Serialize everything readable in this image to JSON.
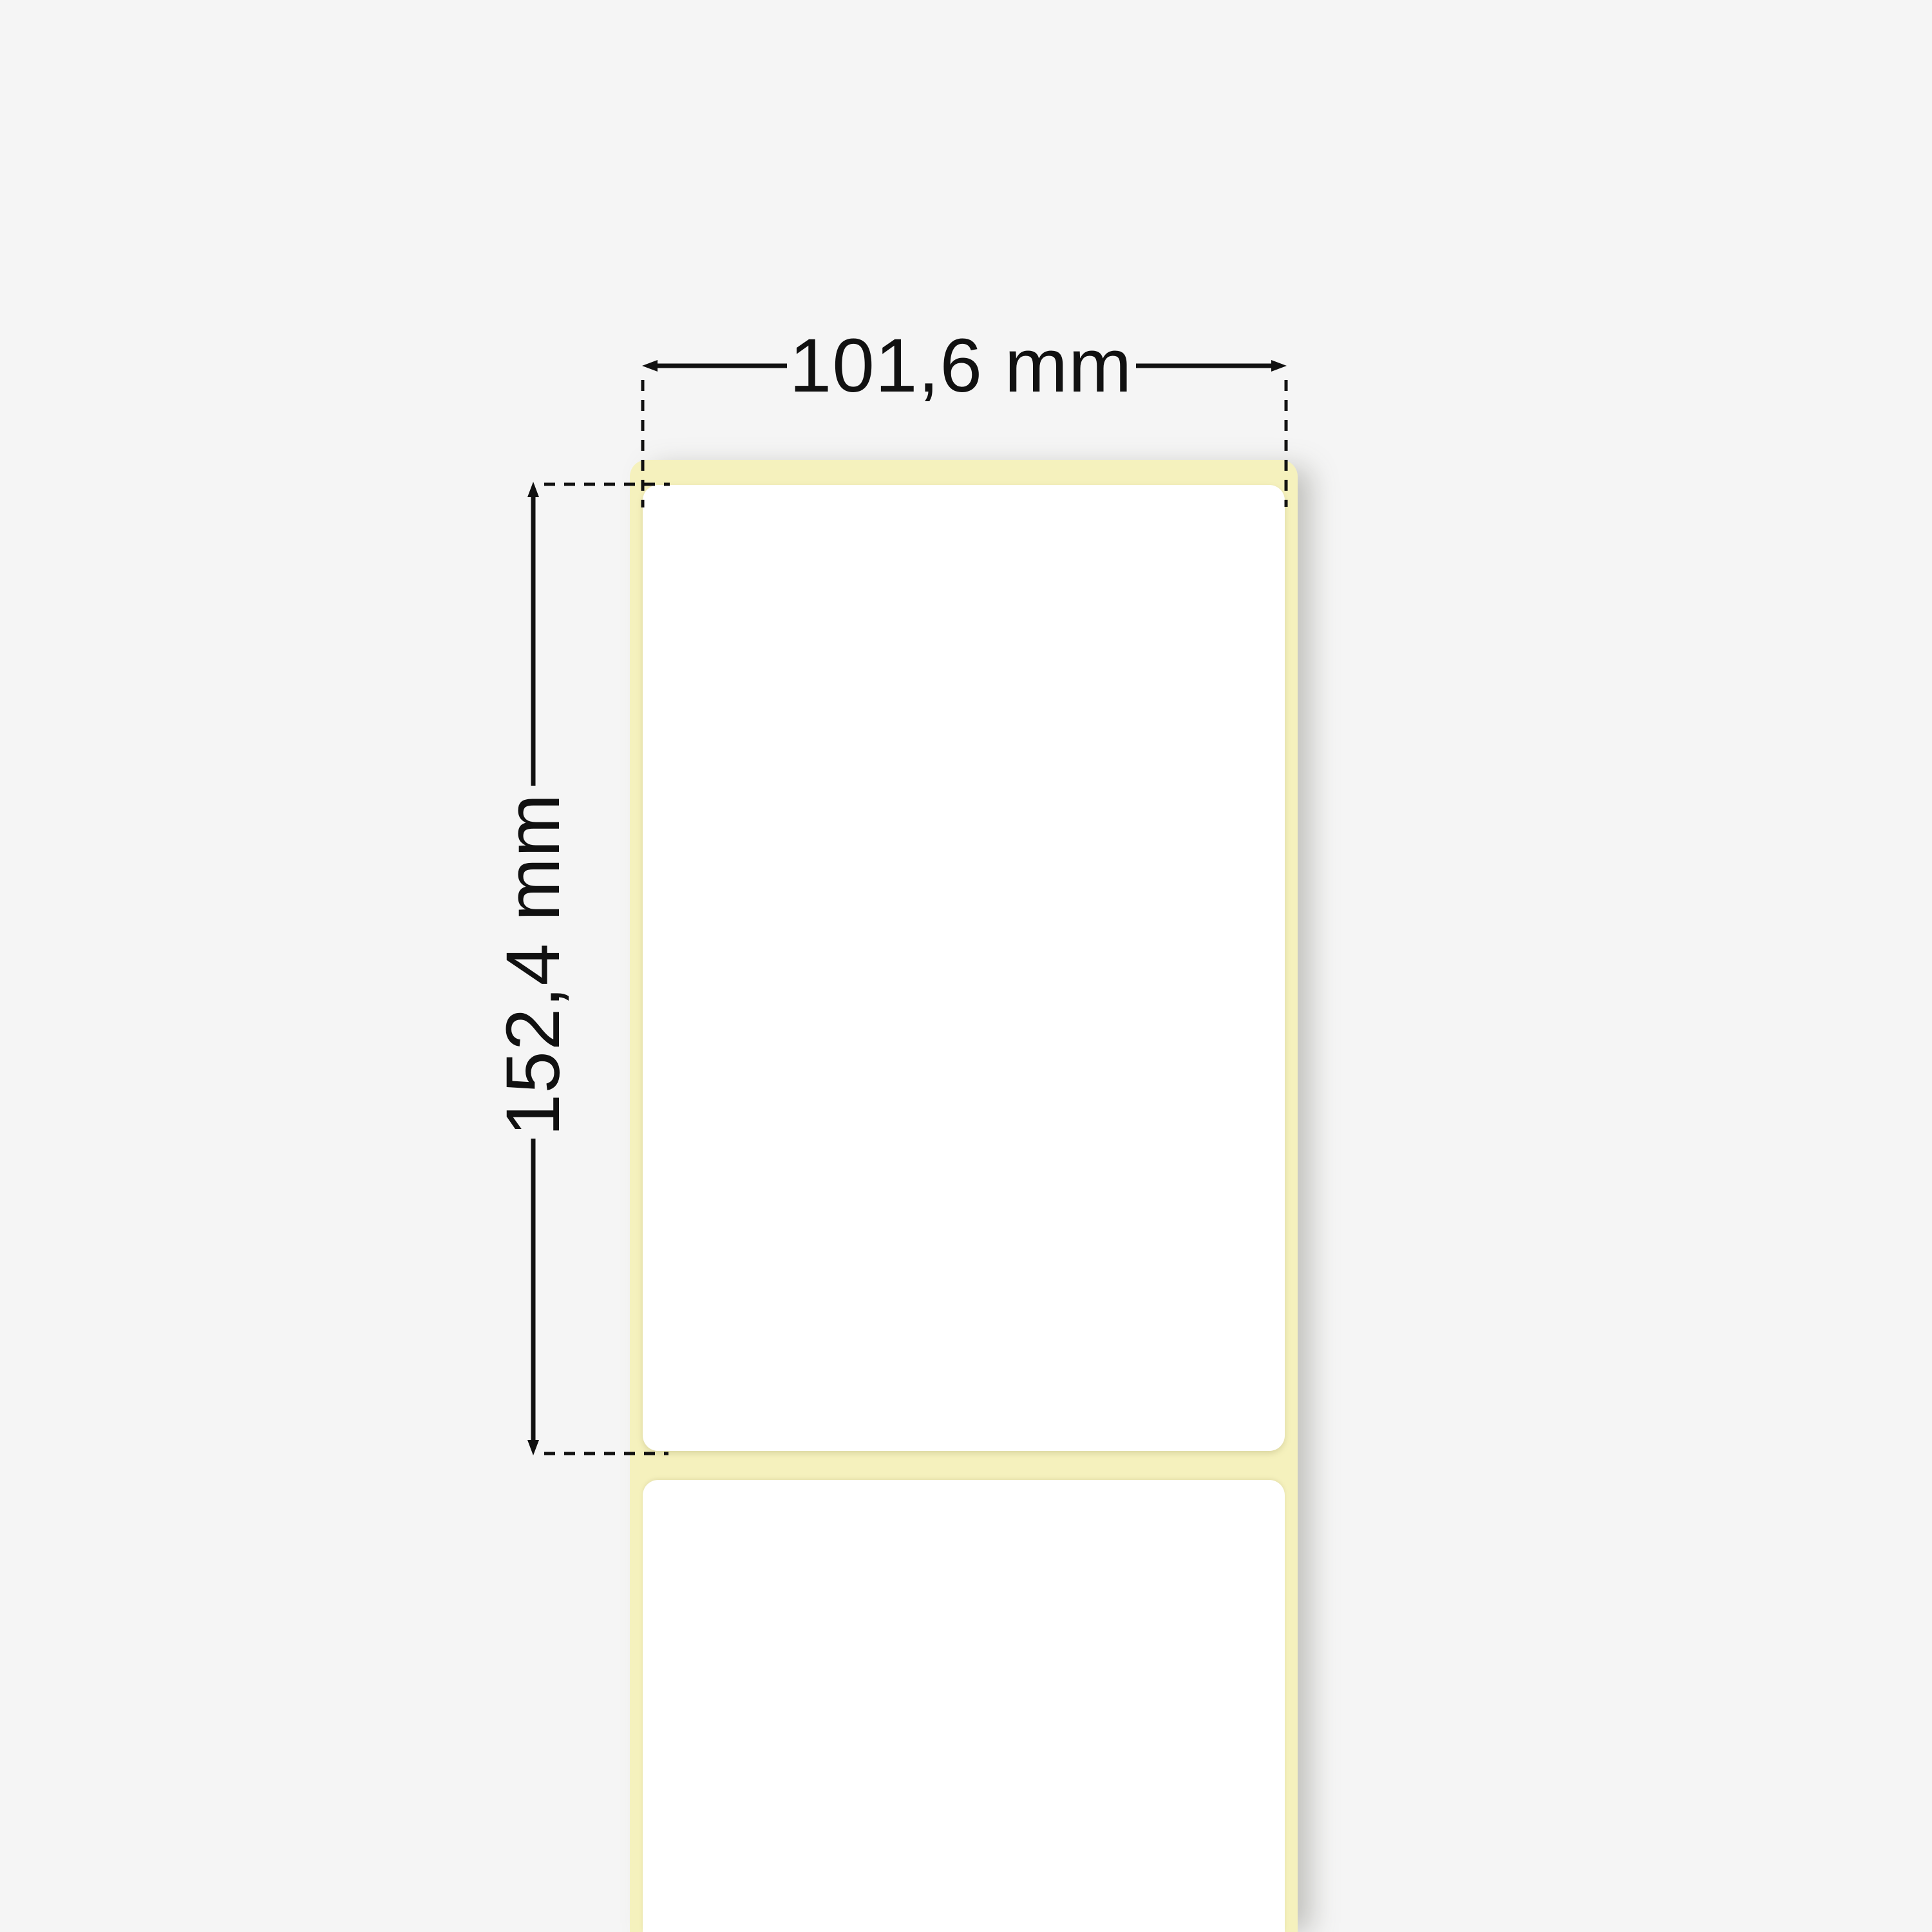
{
  "page": {
    "background_color": "#f5f5f5"
  },
  "diagram": {
    "type": "label-roll-dimension-diagram",
    "liner_color": "#f5f1bd",
    "label_color": "#ffffff",
    "dimension_line_color": "#111111",
    "dimensions": {
      "width": {
        "label": "101,6 mm"
      },
      "height": {
        "label": "152,4 mm"
      }
    }
  }
}
